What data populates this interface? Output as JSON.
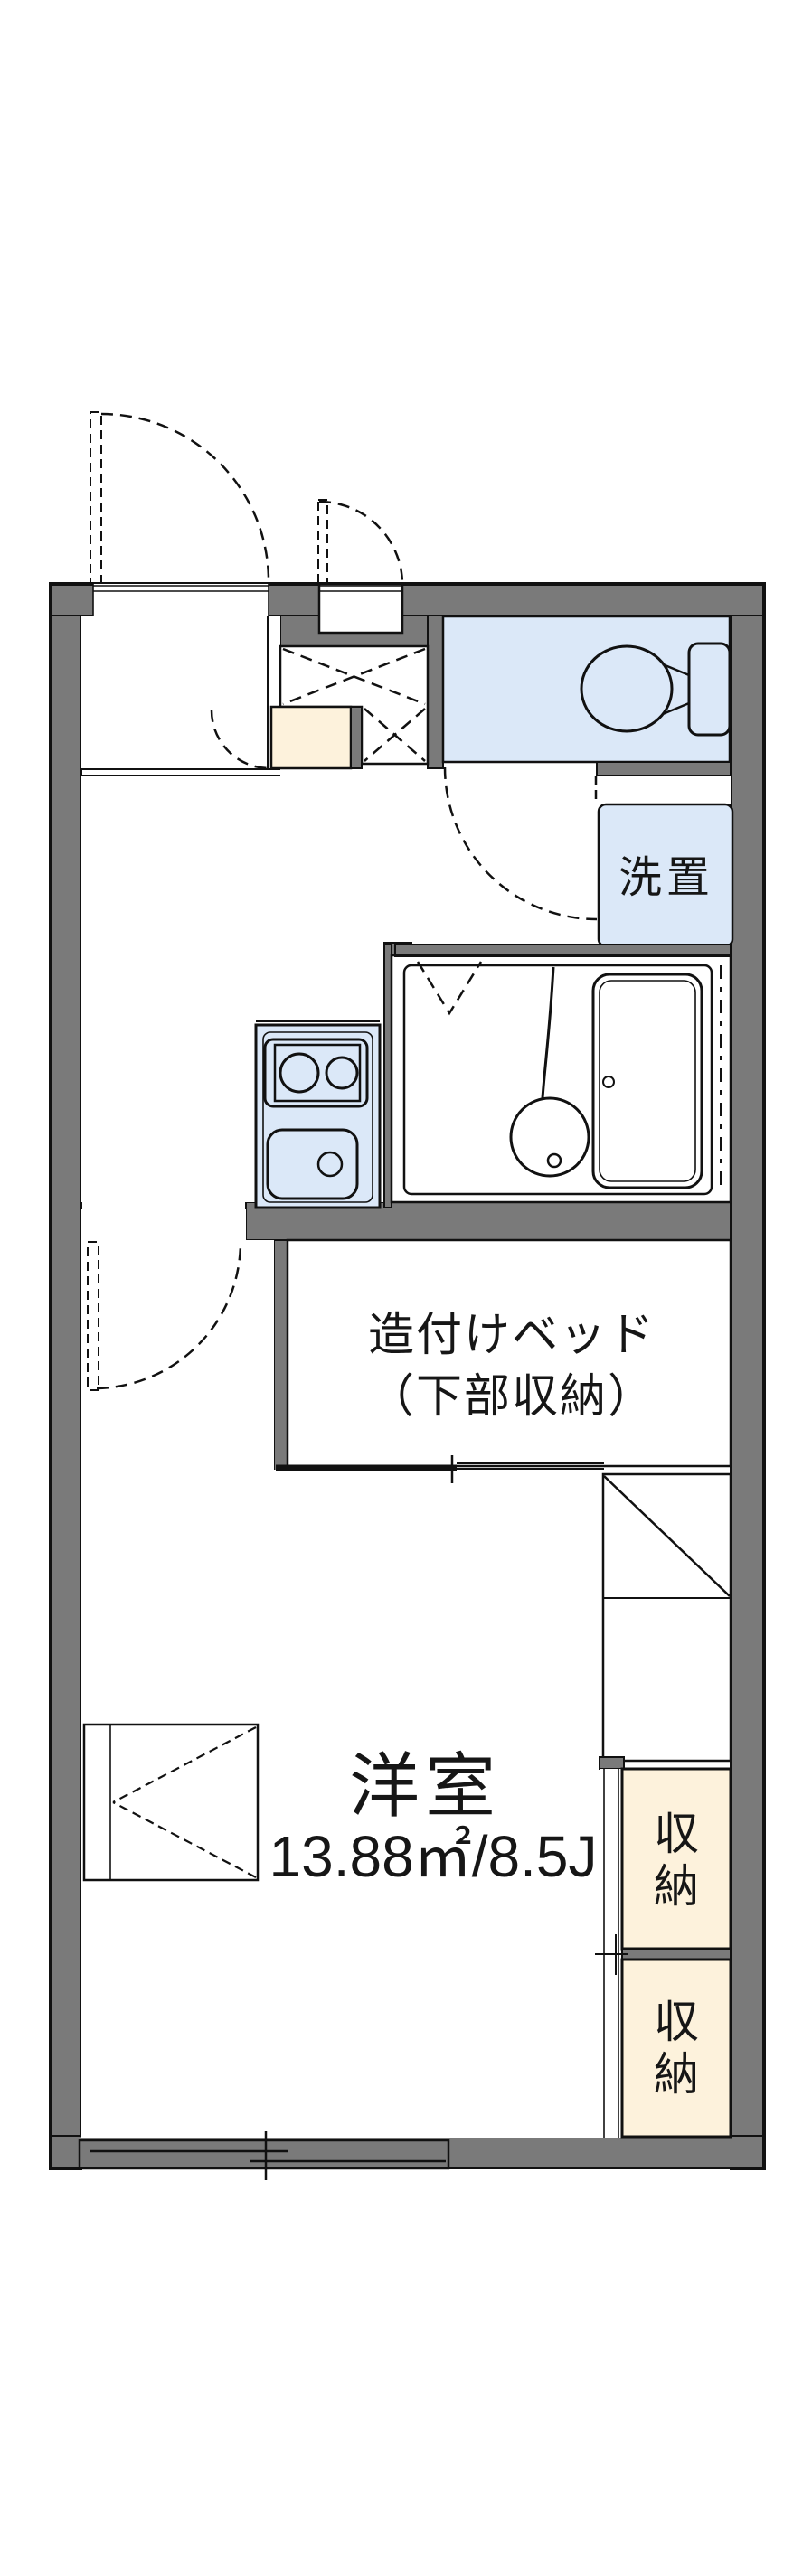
{
  "plan": {
    "type": "japanese-apartment-floorplan",
    "labels": {
      "living_room": {
        "name": "洋室",
        "area": "13.88㎡/8.5J"
      },
      "built_in_bed": {
        "line1": "造付けベッド",
        "line2": "（下部収納）"
      },
      "laundry": "洗置",
      "storage_upper": "収納",
      "storage_lower": "収納"
    },
    "colors": {
      "wall": "#7a7a7a",
      "wet-area": "#dbe8f8",
      "storage-fill": "#fdf2dc",
      "line": "#111111",
      "background": "#ffffff"
    },
    "fixtures": [
      "entrance-door-swing",
      "interior-door-swing",
      "shoe-cabinet",
      "meter-box",
      "toilet",
      "washing-machine-space",
      "bathtub",
      "washbasin",
      "two-burner-stove",
      "kitchen-sink",
      "built-in-bed",
      "refrigerator-space",
      "storage-closet",
      "storage-closet",
      "folding-table",
      "sliding-window",
      "pipe-space"
    ]
  }
}
